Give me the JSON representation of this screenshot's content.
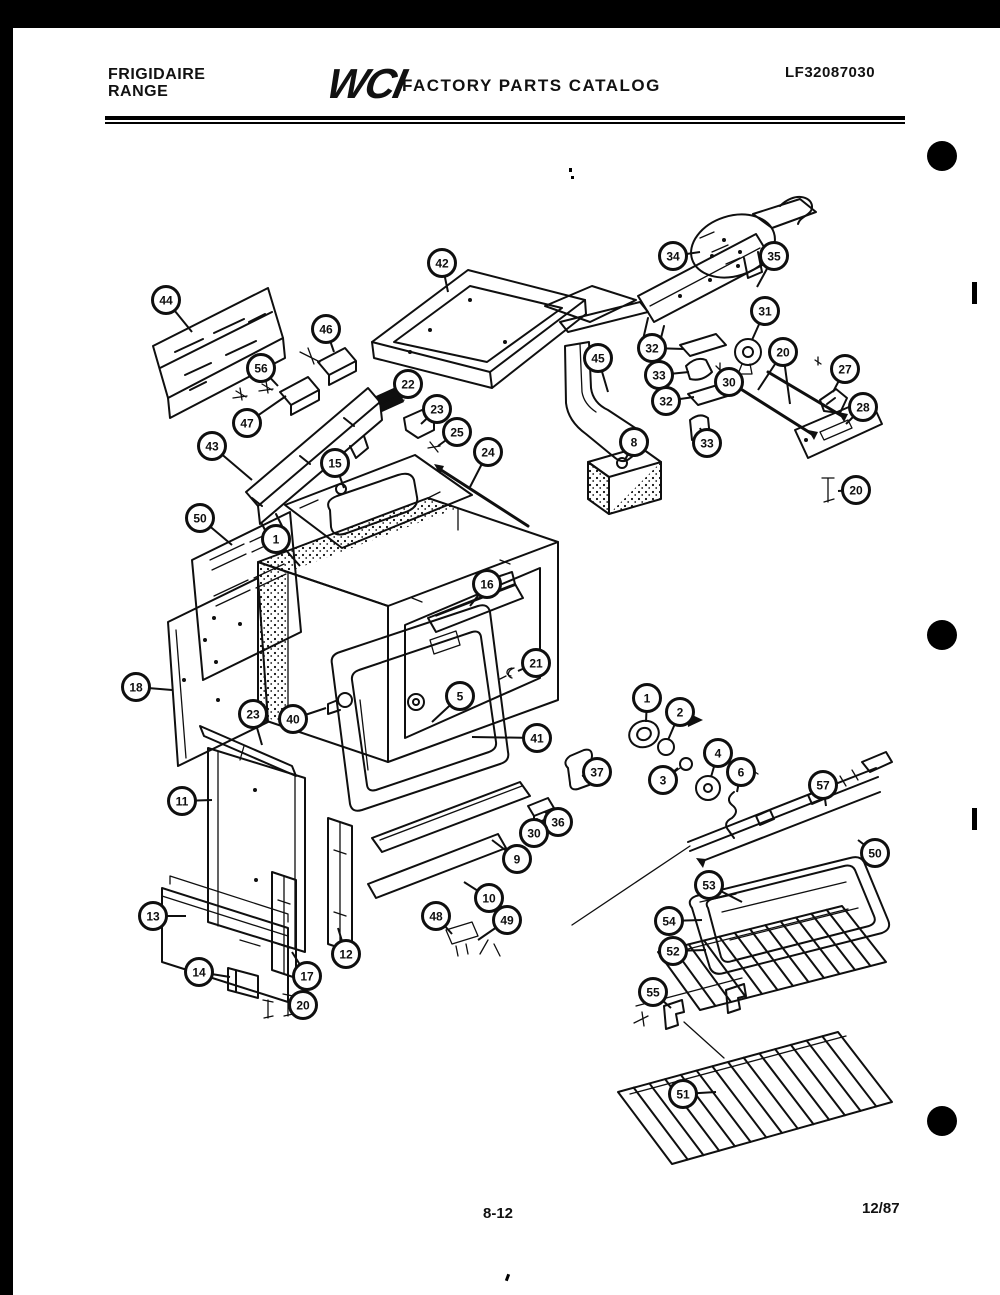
{
  "page": {
    "header": {
      "brand_line1": "FRIGIDAIRE",
      "brand_line2": "RANGE",
      "logo": "WCI",
      "catalog_title": "FACTORY PARTS CATALOG",
      "document_number": "LF32087030"
    },
    "footer": {
      "page_number": "8-12",
      "revision_date": "12/87"
    },
    "colors": {
      "ink": "#0f0f0f",
      "paper": "#ffffff"
    }
  },
  "diagram": {
    "description": "Exploded view of range body, door, drawer, burner box, motor assembly, gas manifold, broiler pan and oven racks",
    "callouts": [
      {
        "label": "44",
        "x": 166,
        "y": 300,
        "lx": 192,
        "ly": 332
      },
      {
        "label": "46",
        "x": 326,
        "y": 329,
        "lx": 334,
        "ly": 352
      },
      {
        "label": "56",
        "x": 261,
        "y": 368,
        "lx": 278,
        "ly": 386
      },
      {
        "label": "47",
        "x": 247,
        "y": 423,
        "lx": 286,
        "ly": 396
      },
      {
        "label": "43",
        "x": 212,
        "y": 446,
        "lx": 252,
        "ly": 480
      },
      {
        "label": "42",
        "x": 442,
        "y": 263,
        "lx": 448,
        "ly": 292
      },
      {
        "label": "22",
        "x": 408,
        "y": 384,
        "lx": 392,
        "ly": 402
      },
      {
        "label": "23",
        "x": 437,
        "y": 409,
        "lx": 421,
        "ly": 424
      },
      {
        "label": "25",
        "x": 457,
        "y": 432,
        "lx": 438,
        "ly": 446
      },
      {
        "label": "24",
        "x": 488,
        "y": 452,
        "lx": 470,
        "ly": 487
      },
      {
        "label": "15",
        "x": 335,
        "y": 463,
        "lx": 344,
        "ly": 488
      },
      {
        "label": "45",
        "x": 598,
        "y": 358,
        "lx": 608,
        "ly": 392
      },
      {
        "label": "8",
        "x": 634,
        "y": 442,
        "lx": 625,
        "ly": 460
      },
      {
        "label": "34",
        "x": 673,
        "y": 256,
        "lx": 700,
        "ly": 252
      },
      {
        "label": "35",
        "x": 774,
        "y": 256,
        "lx": 757,
        "ly": 287
      },
      {
        "label": "31",
        "x": 765,
        "y": 311,
        "lx": 752,
        "ly": 340
      },
      {
        "label": "32",
        "x": 652,
        "y": 348,
        "lx": 684,
        "ly": 349
      },
      {
        "label": "33",
        "x": 659,
        "y": 375,
        "lx": 689,
        "ly": 372
      },
      {
        "label": "32",
        "x": 666,
        "y": 401,
        "lx": 694,
        "ly": 397
      },
      {
        "label": "30",
        "x": 729,
        "y": 382,
        "lx": 722,
        "ly": 372
      },
      {
        "label": "20",
        "x": 783,
        "y": 352,
        "lx": 758,
        "ly": 390,
        "lx2": 790,
        "ly2": 404
      },
      {
        "label": "27",
        "x": 845,
        "y": 369,
        "lx": 833,
        "ly": 392
      },
      {
        "label": "28",
        "x": 863,
        "y": 407,
        "lx": 846,
        "ly": 424
      },
      {
        "label": "20",
        "x": 856,
        "y": 490,
        "lx": 838,
        "ly": 491
      },
      {
        "label": "33",
        "x": 707,
        "y": 443,
        "lx": 700,
        "ly": 428
      },
      {
        "label": "50",
        "x": 200,
        "y": 518,
        "lx": 232,
        "ly": 545
      },
      {
        "label": "1",
        "x": 276,
        "y": 539,
        "lx": 300,
        "ly": 566
      },
      {
        "label": "16",
        "x": 487,
        "y": 584,
        "lx": 470,
        "ly": 606
      },
      {
        "label": "18",
        "x": 136,
        "y": 687,
        "lx": 172,
        "ly": 690
      },
      {
        "label": "21",
        "x": 536,
        "y": 663,
        "lx": 518,
        "ly": 671
      },
      {
        "label": "5",
        "x": 460,
        "y": 696,
        "lx": 432,
        "ly": 722
      },
      {
        "label": "40",
        "x": 293,
        "y": 719,
        "lx": 326,
        "ly": 708
      },
      {
        "label": "23",
        "x": 253,
        "y": 714,
        "lx": 262,
        "ly": 745
      },
      {
        "label": "41",
        "x": 537,
        "y": 738,
        "lx": 472,
        "ly": 737
      },
      {
        "label": "37",
        "x": 597,
        "y": 772,
        "lx": 582,
        "ly": 776
      },
      {
        "label": "36",
        "x": 558,
        "y": 822,
        "lx": 545,
        "ly": 812
      },
      {
        "label": "30",
        "x": 534,
        "y": 833,
        "lx": 527,
        "ly": 822
      },
      {
        "label": "9",
        "x": 517,
        "y": 859,
        "lx": 492,
        "ly": 840
      },
      {
        "label": "10",
        "x": 489,
        "y": 898,
        "lx": 464,
        "ly": 882
      },
      {
        "label": "48",
        "x": 436,
        "y": 916,
        "lx": 452,
        "ly": 934
      },
      {
        "label": "49",
        "x": 507,
        "y": 920,
        "lx": 478,
        "ly": 940
      },
      {
        "label": "11",
        "x": 182,
        "y": 801,
        "lx": 212,
        "ly": 800
      },
      {
        "label": "13",
        "x": 153,
        "y": 916,
        "lx": 186,
        "ly": 916
      },
      {
        "label": "14",
        "x": 199,
        "y": 972,
        "lx": 230,
        "ly": 977
      },
      {
        "label": "17",
        "x": 307,
        "y": 976,
        "lx": 292,
        "ly": 952
      },
      {
        "label": "12",
        "x": 346,
        "y": 954,
        "lx": 338,
        "ly": 928
      },
      {
        "label": "20",
        "x": 303,
        "y": 1005,
        "lx": 291,
        "ly": 1003
      },
      {
        "label": "1",
        "x": 647,
        "y": 698,
        "lx": 646,
        "ly": 722
      },
      {
        "label": "2",
        "x": 680,
        "y": 712,
        "lx": 668,
        "ly": 740
      },
      {
        "label": "4",
        "x": 718,
        "y": 753,
        "lx": 711,
        "ly": 777
      },
      {
        "label": "3",
        "x": 663,
        "y": 780,
        "lx": 678,
        "ly": 768
      },
      {
        "label": "6",
        "x": 741,
        "y": 772,
        "lx": 737,
        "ly": 792
      },
      {
        "label": "57",
        "x": 823,
        "y": 785,
        "lx": 826,
        "ly": 806
      },
      {
        "label": "50",
        "x": 875,
        "y": 853,
        "lx": 858,
        "ly": 840
      },
      {
        "label": "53",
        "x": 709,
        "y": 885,
        "lx": 742,
        "ly": 902
      },
      {
        "label": "54",
        "x": 669,
        "y": 921,
        "lx": 702,
        "ly": 920
      },
      {
        "label": "52",
        "x": 673,
        "y": 951,
        "lx": 706,
        "ly": 950
      },
      {
        "label": "55",
        "x": 653,
        "y": 992,
        "lx": 671,
        "ly": 1008
      },
      {
        "label": "51",
        "x": 683,
        "y": 1094,
        "lx": 716,
        "ly": 1092
      }
    ]
  }
}
